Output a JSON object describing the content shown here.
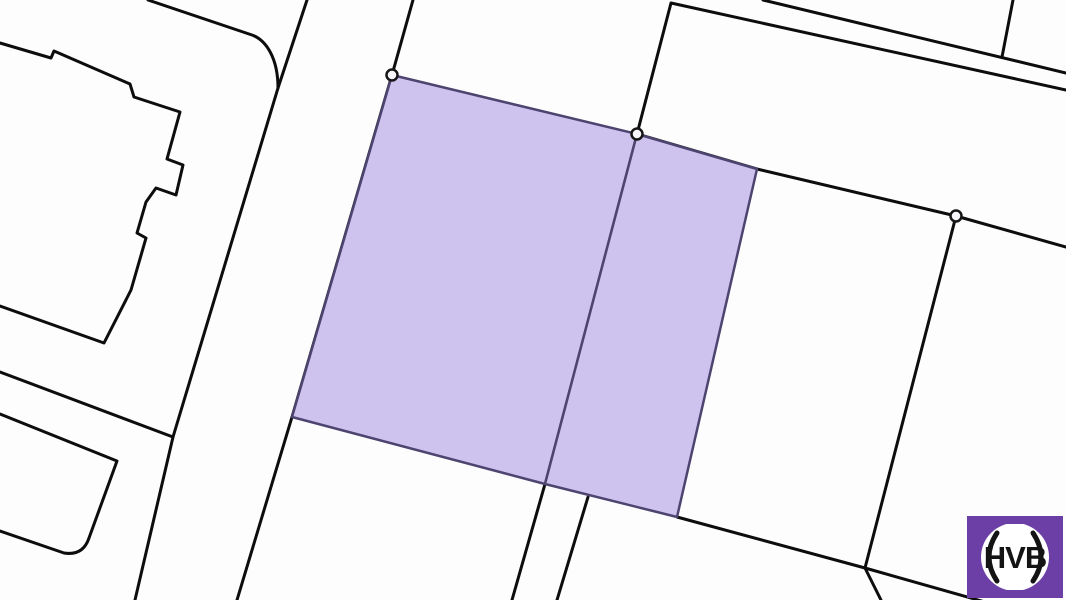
{
  "title": "Cadastral parcel map with highlighted plots",
  "map": {
    "background_color": "#fdfdfd",
    "boundary_color": "#0d0d0d",
    "boundary_width": 3,
    "parcel_fill_color": "#cdc3ee",
    "parcel_outline_color": "#4d4570",
    "parcel_outline_width": 2.5,
    "highlighted_parcel_count": 2,
    "boundary_paths": [
      {
        "name": "building-northwest-outline",
        "d": "M0 43 L51 58 L54 51 L130 84 L134 97 L180 112 L167 159 L183 165 L176 195 L156 188 L146 202 L137 233 L146 238 L131 290 L104 343 L0 306"
      },
      {
        "name": "building-southwest-outline",
        "d": "M0 414 L117 461 L89 538 Q83 556 64 553 L0 531"
      },
      {
        "name": "street-corner-with-fillet",
        "d": "M148 0 L252 35 C266 40 278 58 278 88"
      },
      {
        "name": "road-west-edge",
        "d": "M307 0 L278 88 L173 437 L135 600"
      },
      {
        "name": "block-boundary-west",
        "d": "M0 372 L173 437"
      },
      {
        "name": "parcel-west-boundary-line",
        "d": "M413 0 L392 75 L292 417 L237 600"
      },
      {
        "name": "south-strip-line-left",
        "d": "M545 484 L512 600"
      },
      {
        "name": "south-strip-line-right",
        "d": "M588 497 L557 600"
      },
      {
        "name": "south-boundary-line",
        "d": "M677 517 L865 568 L985 602"
      },
      {
        "name": "south-junction-drop",
        "d": "M865 568 L881 600"
      },
      {
        "name": "north-boundary-from-vertex",
        "d": "M637 134 L671 3 L1066 90"
      },
      {
        "name": "street-northeast-upper-edge",
        "d": "M763 0 L1066 73"
      },
      {
        "name": "north-parcel-divider",
        "d": "M1013 0 L1002 57"
      },
      {
        "name": "east-boundary-line",
        "d": "M637 134 L757 169 L956 216 L1066 247"
      },
      {
        "name": "east-vertex-drop-line",
        "d": "M956 216 L865 568"
      }
    ],
    "highlighted_parcels": [
      {
        "name": "highlighted-parcel-west",
        "points": "392,75 637,134 545,484 292,417"
      },
      {
        "name": "highlighted-parcel-east",
        "points": "637,134 757,169 677,517 545,484"
      }
    ],
    "vertex_markers": {
      "radius": 5.5,
      "stroke_color": "#161616",
      "fill_color": "#f8f6fc",
      "points": [
        [
          392,
          75
        ],
        [
          637,
          134
        ],
        [
          956,
          216
        ]
      ]
    }
  },
  "logo": {
    "text": "HVB",
    "background_color": "#6b3fa6",
    "disc_color": "#ffffff",
    "text_color": "#141414",
    "paren_color": "#141414"
  }
}
